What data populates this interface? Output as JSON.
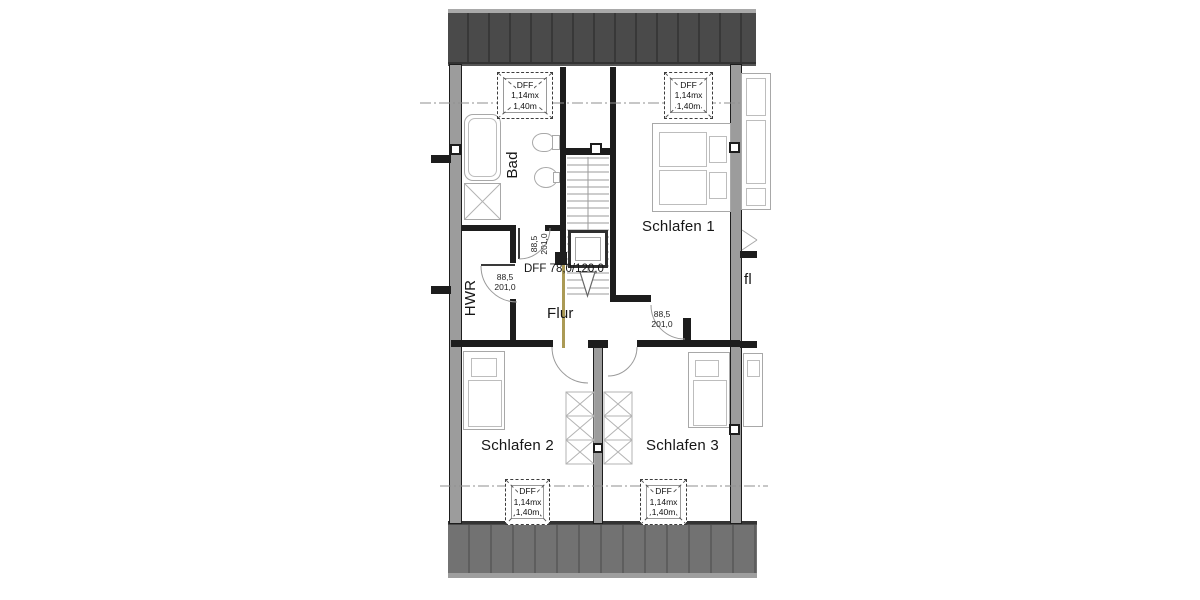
{
  "plan": {
    "rooms": {
      "bad": "Bad",
      "hwr": "HWR",
      "flur": "Flur",
      "schlafen1": "Schlafen 1",
      "schlafen2": "Schlafen 2",
      "schlafen3": "Schlafen 3",
      "neighbor": "fl"
    },
    "skylight": {
      "line1": "DFF",
      "line2": "1,14mx",
      "line3": "1,40m"
    },
    "stair_skylight": "DFF 78,0/120,0",
    "door": {
      "width": "88,5",
      "height": "201,0"
    },
    "colors": {
      "roof_top": "#4a4a4a",
      "roof_top_seam": "#383838",
      "roof_bottom": "#727272",
      "roof_bottom_seam": "#5e5e5e",
      "wall_fill": "#9c9c9c",
      "wall_line": "#1d1d1d",
      "furniture_line": "#a8a8a8",
      "railing": "#ab9a55",
      "arc_line": "#9a9a9a"
    }
  }
}
